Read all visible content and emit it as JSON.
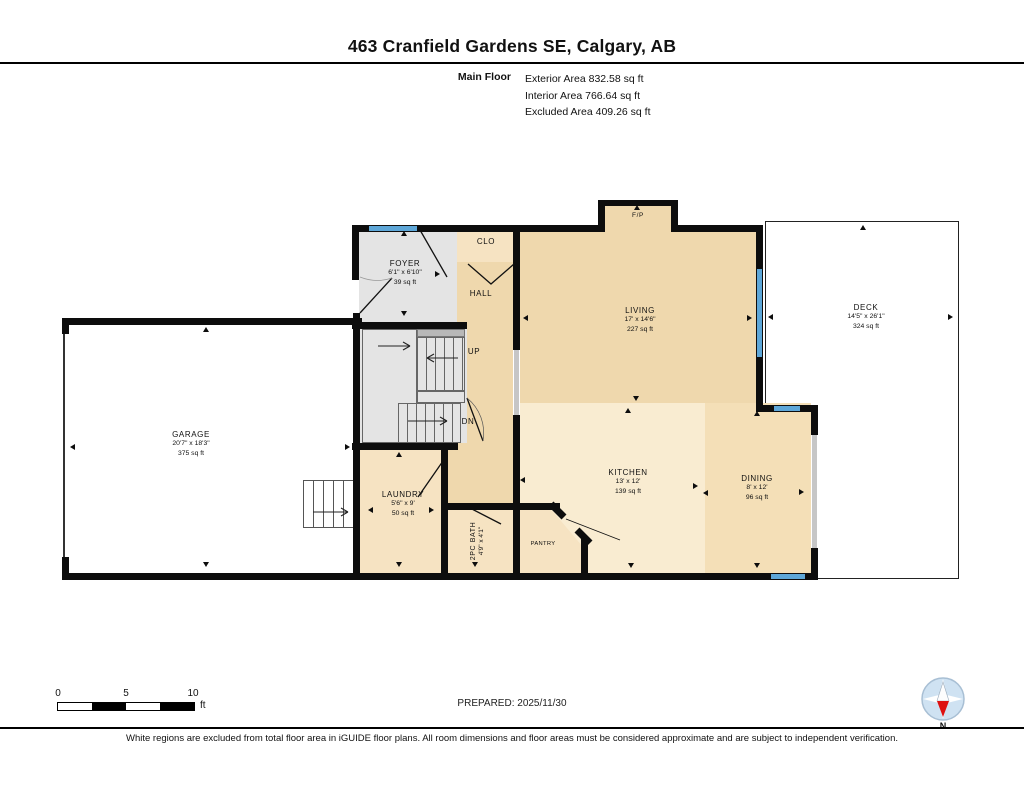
{
  "header": {
    "title": "463 Cranfield Gardens SE, Calgary, AB",
    "floor_label": "Main Floor",
    "stats": {
      "exterior": "Exterior Area 832.58 sq ft",
      "interior": "Interior Area 766.64 sq ft",
      "excluded": "Excluded Area 409.26 sq ft"
    }
  },
  "rooms": {
    "foyer": {
      "name": "FOYER",
      "dims": "6'1\" x 6'10\"",
      "area": "39 sq ft"
    },
    "clo": {
      "name": "CLO"
    },
    "hall": {
      "name": "HALL"
    },
    "up": {
      "name": "UP"
    },
    "dn": {
      "name": "DN"
    },
    "fp": {
      "name": "F/P"
    },
    "living": {
      "name": "LIVING",
      "dims": "17' x 14'6\"",
      "area": "227 sq ft"
    },
    "deck": {
      "name": "DECK",
      "dims": "14'5\" x 26'1\"",
      "area": "324 sq ft"
    },
    "garage": {
      "name": "GARAGE",
      "dims": "20'7\" x 18'3\"",
      "area": "375 sq ft"
    },
    "laundry": {
      "name": "LAUNDRY",
      "dims": "5'6\" x 9'",
      "area": "50 sq ft"
    },
    "bath": {
      "name": "2PC BATH",
      "dims": "4'9\" x 4'1\""
    },
    "pantry": {
      "name": "PANTRY"
    },
    "kitchen": {
      "name": "KITCHEN",
      "dims": "13' x 12'",
      "area": "139 sq ft"
    },
    "dining": {
      "name": "DINING",
      "dims": "8' x 12'",
      "area": "96 sq ft"
    }
  },
  "scale": {
    "t0": "0",
    "t5": "5",
    "t10": "10",
    "unit": "ft"
  },
  "prepared": "PREPARED: 2025/11/30",
  "compass": {
    "label": "N"
  },
  "footer": "White regions are excluded from total floor area in iGUIDE floor plans. All room dimensions and floor areas must be considered approximate and are subject to independent verification.",
  "colors": {
    "wall": "#0d0d0d",
    "window": "#5ea7d8",
    "tan": "#efd8ad",
    "beige": "#f6e3c2",
    "kitchen": "#f9ecd1",
    "dining": "#f4dfb7",
    "gray": "#e4e4e4"
  }
}
